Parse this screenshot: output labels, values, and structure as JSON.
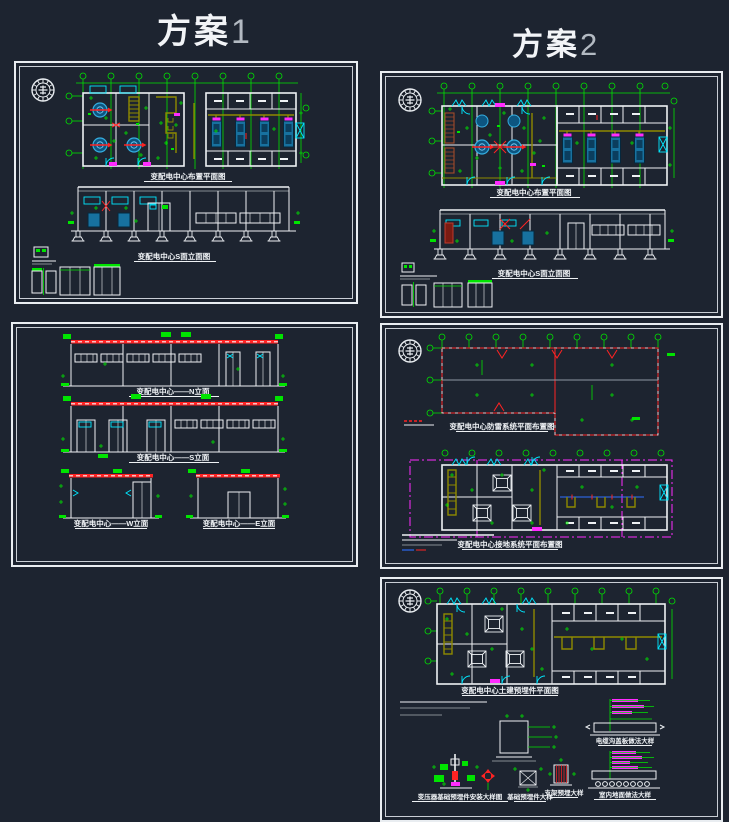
{
  "headers": {
    "scheme1": {
      "label": "方案",
      "number": "1"
    },
    "scheme2": {
      "label": "方案",
      "number": "2"
    }
  },
  "sheets": {
    "s1_layout": {
      "plan_title": "变配电中心布置平面图",
      "elev_title": "变配电中心S面立面图"
    },
    "s2_layout": {
      "plan_title": "变配电中心布置平面图",
      "elev_title": "变配电中心S面立面图"
    },
    "s1_elev": {
      "n": "变配电中心——N立面",
      "s": "变配电中心——S立面",
      "w": "变配电中心——W立面",
      "e": "变配电中心——E立面"
    },
    "s2_sys": {
      "roof": "变配电中心防雷系统平面布置图",
      "ground": "变配电中心接地系统平面布置图"
    },
    "s2_civil": {
      "plan": "变配电中心土建预埋件平面图",
      "d_left": "变压器基础预埋件安装大样图",
      "d_mid": "基础预埋件大样",
      "d_right": "支架预埋大样",
      "sec_top": "电缆沟盖板做法大样",
      "sec_bot": "室内地面做法大样"
    }
  },
  "colors": {
    "background": "#1d2430",
    "line_white": "#eef1f4",
    "dimension_green": "#00e400",
    "equipment_blue": "#1b85c4",
    "cable_tray_olive": "#8f8a00",
    "accent_red": "#ff2323",
    "accent_magenta": "#ff2bff",
    "accent_cyan": "#00e8ff",
    "roof_gray": "#8e97a3"
  }
}
